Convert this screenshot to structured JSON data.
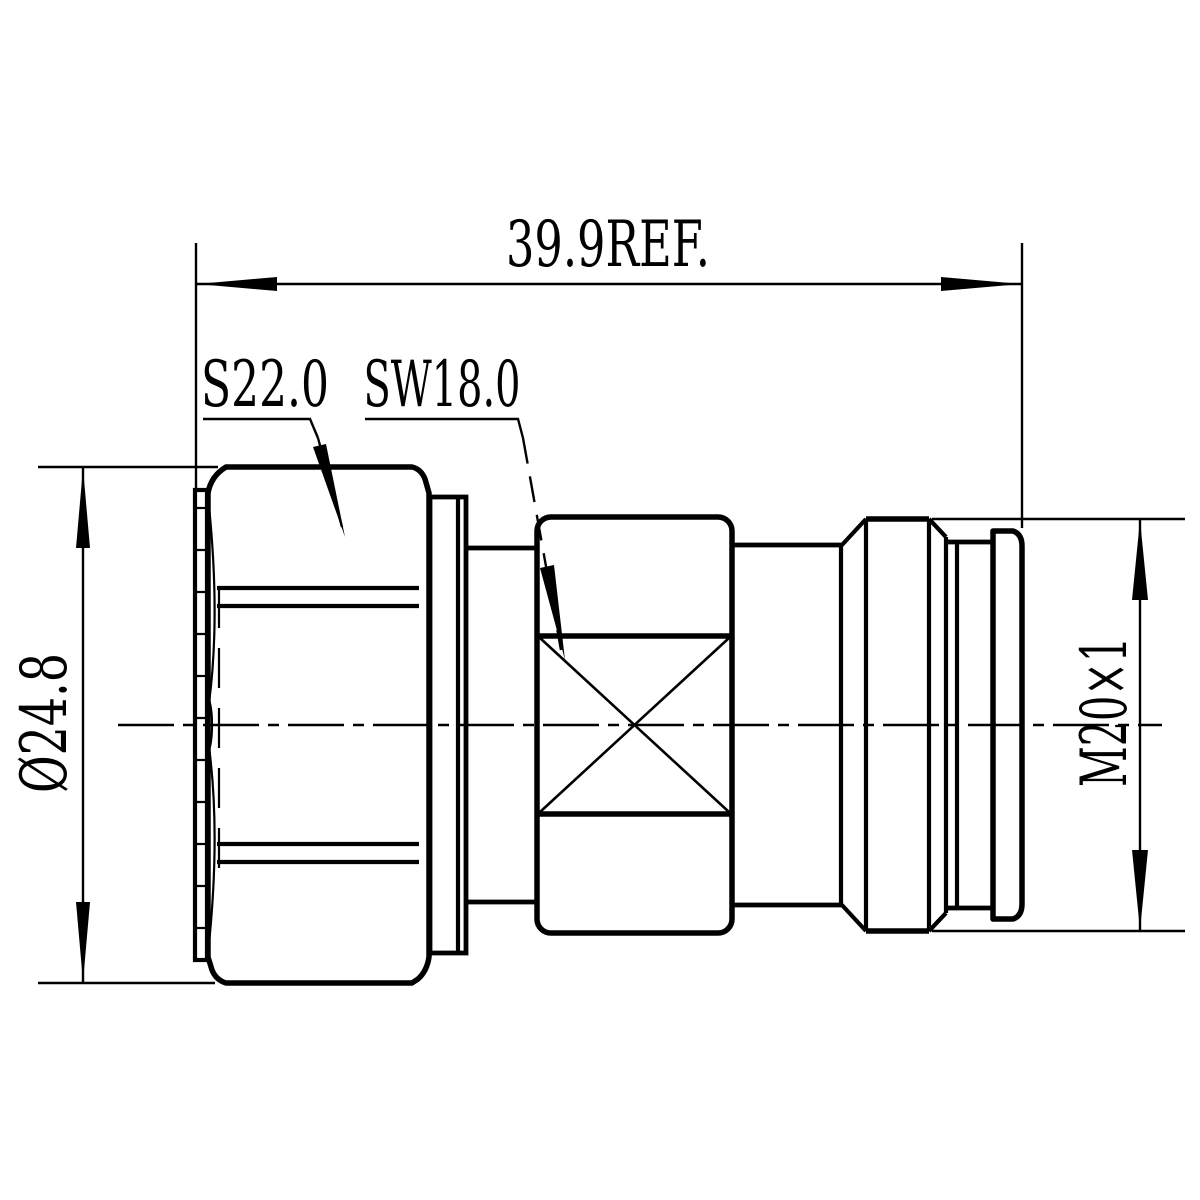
{
  "drawing": {
    "labels": {
      "overall_length": "39.9REF.",
      "hex_size": "S22.0",
      "wrench_size": "SW18.0",
      "outer_diameter": "Ø24.8",
      "thread": "M20×1"
    },
    "colors": {
      "line": "#000000",
      "background": "#ffffff"
    }
  }
}
